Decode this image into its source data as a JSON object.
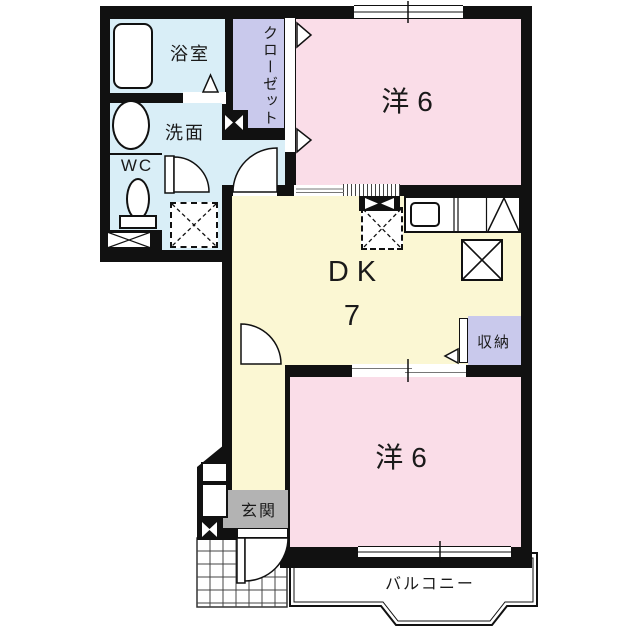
{
  "rooms": {
    "bathroom": "浴室",
    "closet": "クローゼット",
    "washroom": "洗面",
    "toilet": "WC",
    "bedroom_top": "洋6",
    "dining_kitchen": "DK",
    "dining_kitchen_size": "7",
    "storage": "収納",
    "entrance": "玄関",
    "bedroom_bottom": "洋6",
    "balcony": "バルコニー"
  },
  "colors": {
    "wall": "#111111",
    "pink": "#fadde8",
    "yellow": "#fbf7d3",
    "blue": "#d9eef7",
    "lavender": "#c9c9ec",
    "gray": "#b3b3b3"
  }
}
